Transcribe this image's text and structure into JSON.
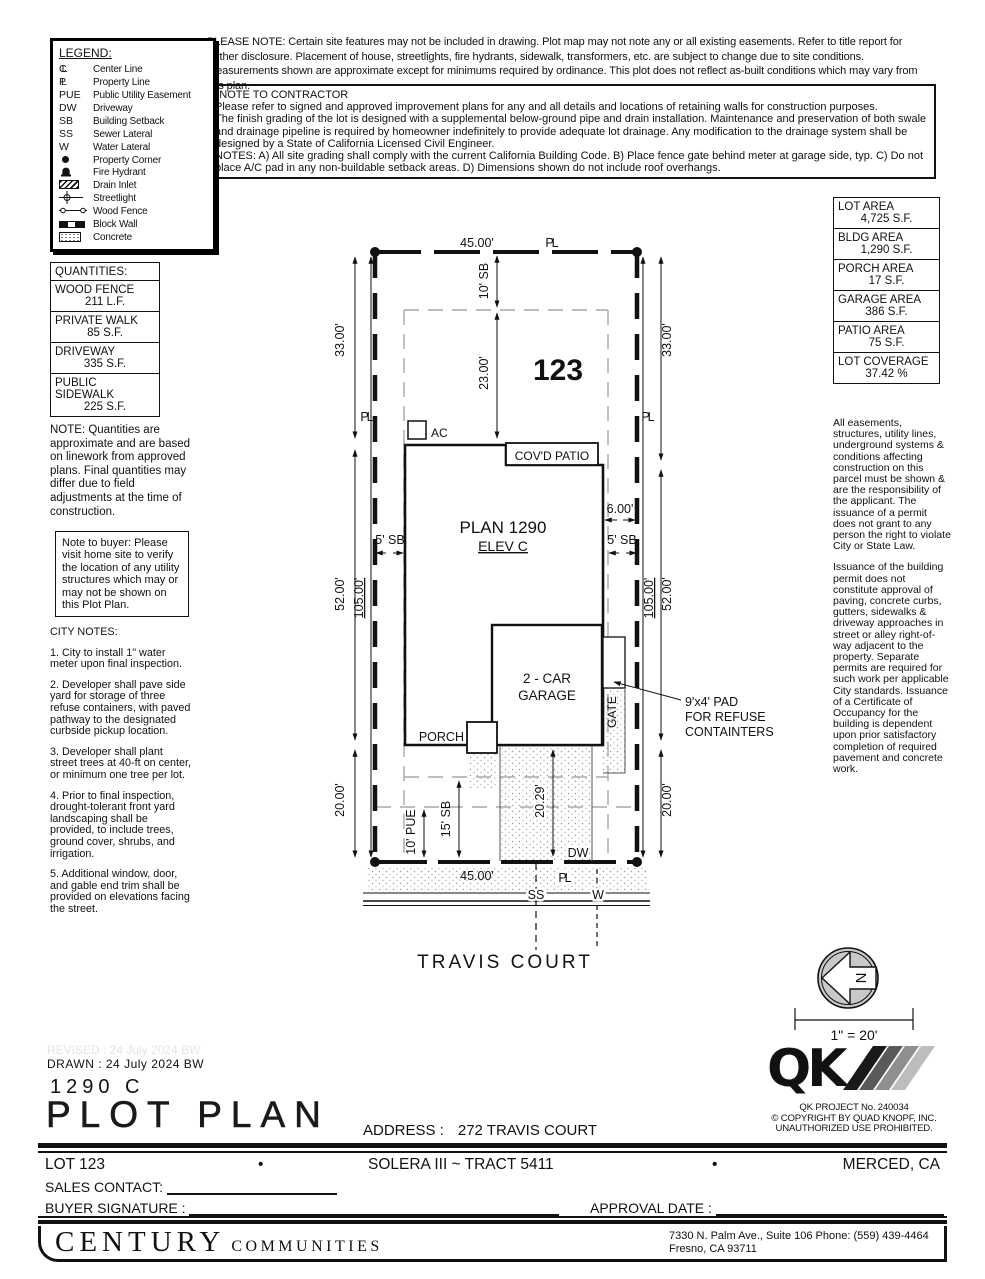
{
  "header_notes": {
    "please_note": "PLEASE NOTE:  Certain site features may not be included in drawing.  Plot map may not note any or all existing easements. Refer to title report for further disclosure.  Placement of house, streetlights, fire hydrants, sidewalk, transformers, etc. are subject to change due to site conditions.  Measurements shown are approximate except for minimums required by ordinance.  This plot does not reflect as-built conditions which may vary from this plan.",
    "contractor_title": "*NOTE TO CONTRACTOR",
    "contractor_body": "Please refer to signed and approved improvement plans for any and all details and locations of retaining walls for construction purposes.\nThe finish grading of the lot is designed with a supplemental below-ground pipe and drain installation.  Maintenance and preservation of both swale and drainage pipeline is required by homeowner indefinitely to provide adequate lot drainage.  Any modification to the drainage system shall be designed by a State of California Licensed Civil Engineer.\nNOTES:  A) All site grading shall comply with the current California Building Code.  B) Place fence gate behind meter at garage side, typ.  C) Do not place A/C pad in any non-buildable setback areas.  D) Dimensions shown do not include roof overhangs."
  },
  "legend": {
    "title": "LEGEND:",
    "items": [
      {
        "sym": "CL",
        "label": "Center Line"
      },
      {
        "sym": "PL",
        "label": "Property Line"
      },
      {
        "sym": "PUE",
        "label": "Public Utility Easement"
      },
      {
        "sym": "DW",
        "label": "Driveway"
      },
      {
        "sym": "SB",
        "label": "Building Setback"
      },
      {
        "sym": "SS",
        "label": "Sewer Lateral"
      },
      {
        "sym": "W",
        "label": "Water Lateral"
      },
      {
        "sym": "",
        "label": "Property Corner",
        "icon": "property-corner-dot"
      },
      {
        "sym": "",
        "label": "Fire Hydrant",
        "icon": "fire-hydrant"
      },
      {
        "sym": "",
        "label": "Drain Inlet",
        "icon": "drain-inlet"
      },
      {
        "sym": "",
        "label": "Streetlight",
        "icon": "streetlight"
      },
      {
        "sym": "",
        "label": "Wood Fence",
        "icon": "wood-fence"
      },
      {
        "sym": "",
        "label": "Block Wall",
        "icon": "block-wall"
      },
      {
        "sym": "",
        "label": "Concrete",
        "icon": "concrete"
      }
    ]
  },
  "quantities": {
    "title": "QUANTITIES:",
    "items": [
      {
        "name": "WOOD FENCE",
        "value": "211 L.F."
      },
      {
        "name": "PRIVATE WALK",
        "value": "85 S.F."
      },
      {
        "name": "DRIVEWAY",
        "value": "335 S.F."
      },
      {
        "name": "PUBLIC SIDEWALK",
        "value": "225 S.F."
      }
    ],
    "note": "NOTE: Quantities are approximate and are based on linework from approved plans.  Final quantities may differ due to field adjustments at the time of construction."
  },
  "buyer_note": "Note to buyer: Please visit home site to verify the location of any utility structures which may or may not be shown on this Plot Plan.",
  "city_notes": {
    "title": "CITY NOTES:",
    "items": [
      "1. City to install 1\" water meter upon final inspection.",
      "2. Developer shall pave side yard for storage of three refuse containers, with paved pathway to the designated curbside pickup location.",
      "3. Developer shall plant street trees at 40-ft on center, or minimum one tree per lot.",
      "4. Prior to final inspection, drought-tolerant front yard landscaping shall be provided, to include trees, ground cover, shrubs, and irrigation.",
      "5. Additional window, door, and gable end trim shall be provided on elevations facing the street."
    ]
  },
  "areas": {
    "items": [
      {
        "label": "LOT AREA",
        "value": "4,725 S.F."
      },
      {
        "label": "BLDG AREA",
        "value": "1,290 S.F."
      },
      {
        "label": "PORCH AREA",
        "value": "17 S.F."
      },
      {
        "label": "GARAGE AREA",
        "value": "386 S.F."
      },
      {
        "label": "PATIO AREA",
        "value": "75 S.F."
      },
      {
        "label": "LOT COVERAGE",
        "value": "37.42 %"
      }
    ]
  },
  "side_notes": {
    "p1": "All easements, structures, utility lines, underground systems & conditions affecting construction on this parcel must be shown & are the responsibility of the applicant. The issuance of a permit does not grant to any person the right to violate City or State Law.",
    "p2": "Issuance of the building permit does not constitute approval of paving, concrete curbs, gutters, sidewalks & driveway approaches in street or alley right-of-way adjacent to the property. Separate permits are required for such work per applicable City standards. Issuance of a Certificate of Occupancy for the building is dependent upon prior satisfactory completion of required pavement and concrete work."
  },
  "drawing": {
    "lot_number": "123",
    "plan": "PLAN 1290",
    "elev": "ELEV C",
    "patio": "COV'D PATIO",
    "garage1": "2 - CAR",
    "garage2": "GARAGE",
    "porch": "PORCH",
    "ac": "AC",
    "gate": "GATE",
    "street": "TRAVIS COURT",
    "dim_45": "45.00'",
    "dim_33": "33.00'",
    "dim_52": "52.00'",
    "dim_20": "20.00'",
    "dim_105": "105.00'",
    "dim_23": "23.00'",
    "dim_6": "6.00'",
    "dim_2029": "20.29'",
    "sb10": "10' SB",
    "sb5": "5' SB",
    "sb15": "15' SB",
    "pue10": "10' PUE",
    "pl": "PL",
    "dw": "DW",
    "ss": "SS",
    "w": "W",
    "pad1": "9'x4' PAD",
    "pad2": "FOR REFUSE",
    "pad3": "CONTAINTERS",
    "north": "N",
    "scale": "1\" = 20'"
  },
  "qk": {
    "logo": "QK",
    "project": "QK PROJECT No. 240034",
    "copyright": "©  COPYRIGHT BY QUAD KNOPF, INC.",
    "unauthorized": "UNAUTHORIZED USE PROHIBITED."
  },
  "titleblock": {
    "revised": "REVISED :  24 July 2024  BW",
    "drawn": "DRAWN :  24 July 2024  BW",
    "plan_code": "1290  C",
    "sheet_title": "PLOT PLAN",
    "address_label": "ADDRESS :",
    "address_value": "272 TRAVIS COURT",
    "lot": "LOT 123",
    "bullet": "•",
    "tract": "SOLERA III ~ TRACT 5411",
    "city": "MERCED, CA",
    "sales_label": "SALES CONTACT:",
    "buyer_label": "BUYER SIGNATURE :",
    "approval_label": "APPROVAL DATE :"
  },
  "footer": {
    "brand_primary": "CENTURY",
    "brand_secondary": "COMMUNITIES",
    "address_line1": "7330 N. Palm Ave., Suite 106    Phone:  (559) 439-4464",
    "address_line2": "Fresno, CA  93711"
  }
}
